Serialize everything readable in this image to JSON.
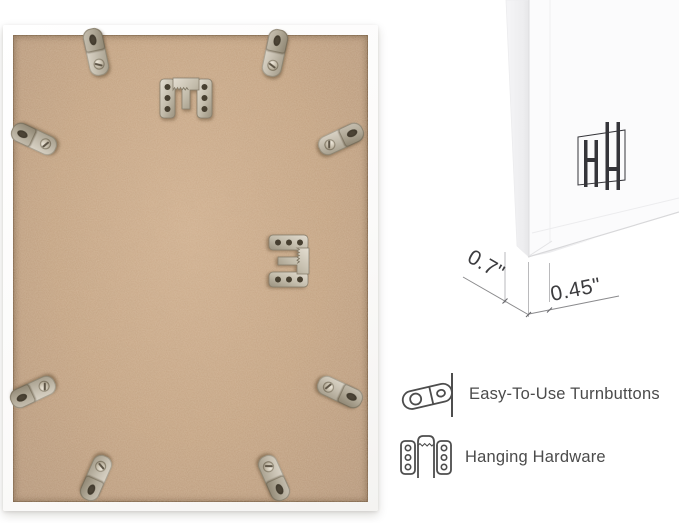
{
  "image_type": "product-photo-infographic",
  "frame_back_photo": {
    "turnbutton_count": 8,
    "hanger_count": 2,
    "backing_color": "#c3a282",
    "frame_color": "#fcfcfc",
    "metal_color": "#c9c2b3"
  },
  "corner_closeup": {
    "dimensions": {
      "depth": "0.7\"",
      "face_width": "0.45\""
    },
    "logo": {
      "name": "hh-monogram",
      "monogram": "HH",
      "color": "#35353a"
    }
  },
  "features": [
    {
      "icon": "turnbutton-icon",
      "label": "Easy-To-Use Turnbuttons"
    },
    {
      "icon": "hanging-hardware-icon",
      "label": "Hanging Hardware"
    }
  ],
  "colors": {
    "background": "#ffffff",
    "label_text": "#4b4b4b",
    "dimension_text": "#3c3c3f",
    "dimension_line": "#8a8a8c"
  }
}
